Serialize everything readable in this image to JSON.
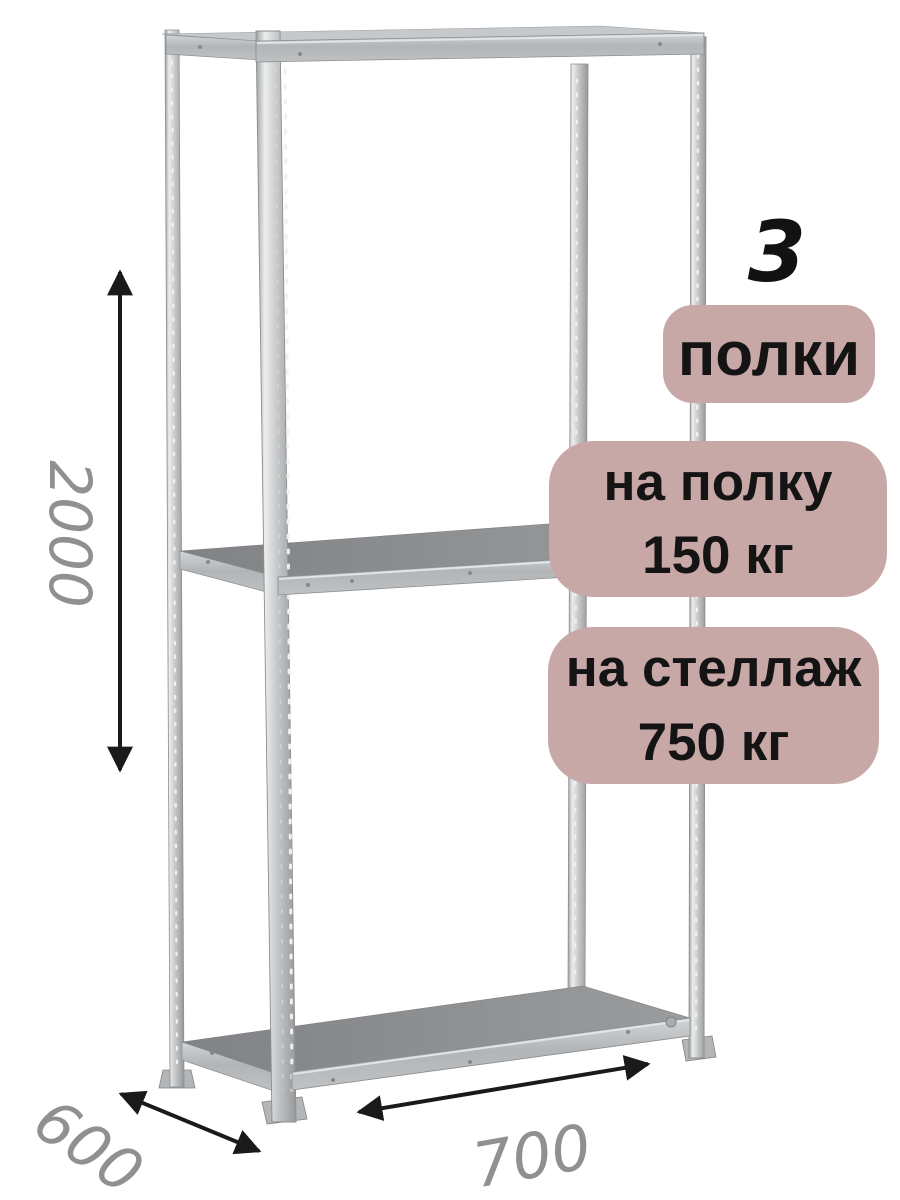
{
  "figure": {
    "name": "metal-shelving-rack",
    "description_visible": ""
  },
  "dimensions": {
    "height": "2000",
    "depth": "600",
    "width": "700"
  },
  "badges": {
    "count_value": "3",
    "count_label": "полки",
    "per_shelf_line1": "на полку",
    "per_shelf_line2": "150 кг",
    "per_rack_line1": "на стеллаж",
    "per_rack_line2": "750 кг"
  },
  "colors": {
    "badge_bg": "#c8a8a7",
    "badge_text": "#141414",
    "dimension_text": "#8e9092",
    "arrow": "#1a1a1a",
    "metal_light": "#e9eaeb",
    "metal_mid": "#c3c5c7",
    "shelf_surface": "#8d8f91"
  }
}
